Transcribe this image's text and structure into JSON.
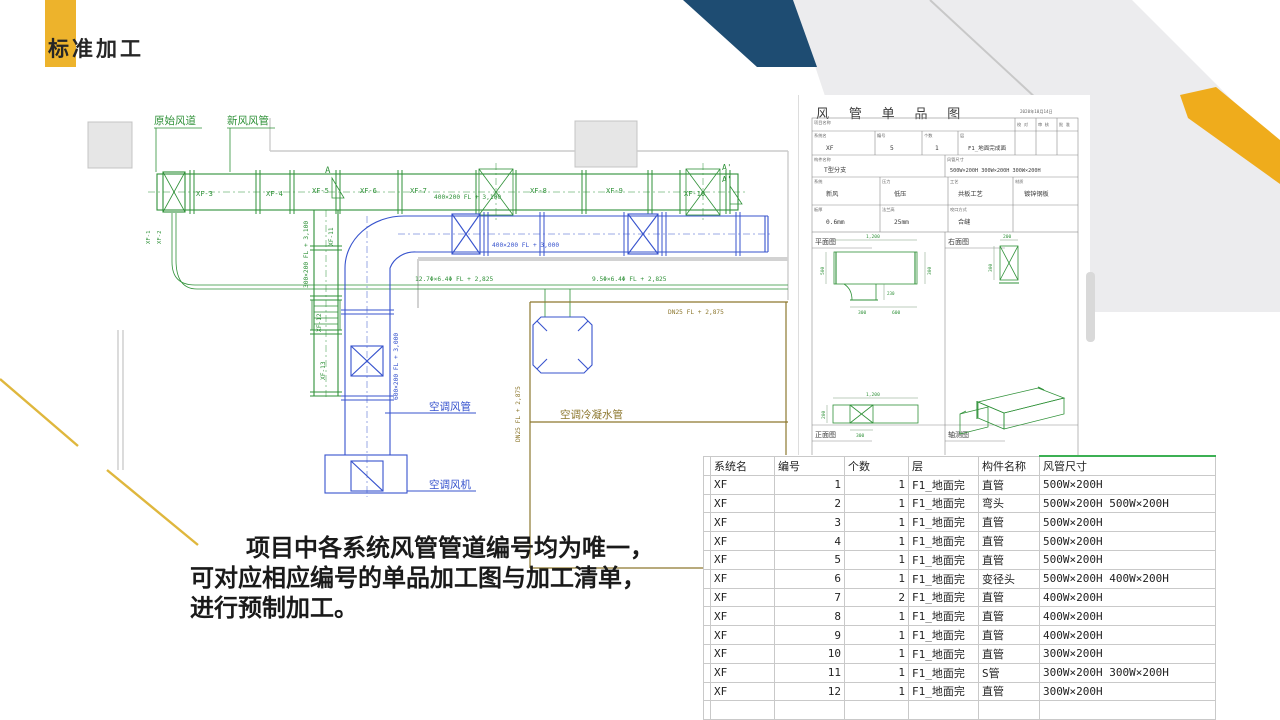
{
  "colors": {
    "accent_yellow": "#EDB32C",
    "navy": "#1E4C72",
    "band_gray": "#ECECEE",
    "cad_green": "#2F9138",
    "cad_blue": "#3753CD",
    "cad_olive": "#8D782F",
    "table_green": "#3CB054"
  },
  "slide": {
    "title": "标准加工"
  },
  "body": {
    "line1": "项目中各系统风管管道编号均为唯一，",
    "line2": "可对应相应编号的单品加工图与加工清单，",
    "line3": "进行预制加工。"
  },
  "cad": {
    "callouts": {
      "original_duct": "原始风道",
      "fresh_air_duct": "新风风管",
      "ac_duct": "空调风管",
      "ac_fan": "空调风机",
      "condensate_pipe": "空调冷凝水管"
    },
    "section_marks": {
      "a": "A",
      "a1": "A'",
      "a2": "A'"
    },
    "segments": {
      "xf1": "XF-1",
      "xf2": "XF-2",
      "xf3": "XF-3",
      "xf4": "XF-4",
      "xf5": "XF-5",
      "xf6": "XF-6",
      "xf7": "XF-7",
      "xf8": "XF-8",
      "xf9": "XF-9",
      "xf10": "XF-10",
      "xf11": "XF-11",
      "xf12": "XF-12",
      "xf13": "XF-13"
    },
    "dims": {
      "main": "400×200 FL + 3,100",
      "blue_h": "400×200 FL + 3,000",
      "blue_v": "600×200 FL + 3,000",
      "green_v": "300×200 FL + 3,100",
      "pipe1": "12.7Φ×6.4Φ FL + 2,825",
      "pipe2": "9.5Φ×6.4Φ FL + 2,825",
      "dn25_h": "DN25 FL + 2,875",
      "dn25_v": "DN25 FL + 2,875"
    }
  },
  "panel": {
    "title": "风 管 单 品 图",
    "date": "2020年10月14日",
    "fields": {
      "project_label": "项目名称",
      "check_label": "校 对",
      "review_label": "审 核",
      "approve_label": "批 准",
      "system_label": "系统名",
      "system": "XF",
      "number_label": "编号",
      "number": "5",
      "count_label": "个数",
      "count": "1",
      "floor_label": "层",
      "floor": "F1_地面完成面",
      "part_label": "构件名称",
      "part": "T型分支",
      "size_label": "风管尺寸",
      "size": "500W×200H 300W×200H 300W×200H",
      "sys_type_label": "系统",
      "sys_type": "新风",
      "pressure_label": "压力",
      "pressure": "低压",
      "process_label": "工艺",
      "process": "共板工艺",
      "material_label": "材质",
      "material": "镀锌钢板",
      "thickness_label": "板厚",
      "thickness": "0.6mm",
      "flange_label": "法兰高",
      "flange": "25mm",
      "seam_label": "咬口方式",
      "seam": "合缝"
    },
    "views": {
      "plan": "平面图",
      "right": "右面图",
      "front": "正面图",
      "axon": "轴测图"
    },
    "dims": {
      "plan_len": "1,200",
      "plan_left": "500",
      "plan_right": "300",
      "branch_len": "230",
      "branch_w": "300",
      "branch_off": "600",
      "right_w": "200",
      "right_h": "300",
      "front_len": "1,200",
      "front_h": "200",
      "front_branch": "300"
    }
  },
  "table": {
    "headers": [
      "",
      "系统名",
      "编号",
      "个数",
      "层",
      "构件名称",
      "风管尺寸"
    ],
    "rows": [
      [
        "",
        "XF",
        "1",
        "1",
        "F1_地面完",
        "直管",
        "500W×200H"
      ],
      [
        "",
        "XF",
        "2",
        "1",
        "F1_地面完",
        "弯头",
        "500W×200H 500W×200H"
      ],
      [
        "",
        "XF",
        "3",
        "1",
        "F1_地面完",
        "直管",
        "500W×200H"
      ],
      [
        "",
        "XF",
        "4",
        "1",
        "F1_地面完",
        "直管",
        "500W×200H"
      ],
      [
        "",
        "XF",
        "5",
        "1",
        "F1_地面完",
        "直管",
        "500W×200H"
      ],
      [
        "",
        "XF",
        "6",
        "1",
        "F1_地面完",
        "变径头",
        "500W×200H 400W×200H"
      ],
      [
        "",
        "XF",
        "7",
        "2",
        "F1_地面完",
        "直管",
        "400W×200H"
      ],
      [
        "",
        "XF",
        "8",
        "1",
        "F1_地面完",
        "直管",
        "400W×200H"
      ],
      [
        "",
        "XF",
        "9",
        "1",
        "F1_地面完",
        "直管",
        "400W×200H"
      ],
      [
        "",
        "XF",
        "10",
        "1",
        "F1_地面完",
        "直管",
        "300W×200H"
      ],
      [
        "",
        "XF",
        "11",
        "1",
        "F1_地面完",
        "S管",
        "300W×200H 300W×200H"
      ],
      [
        "",
        "XF",
        "12",
        "1",
        "F1_地面完",
        "直管",
        "300W×200H"
      ],
      [
        "",
        "",
        "",
        "",
        "",
        "",
        ""
      ]
    ]
  }
}
